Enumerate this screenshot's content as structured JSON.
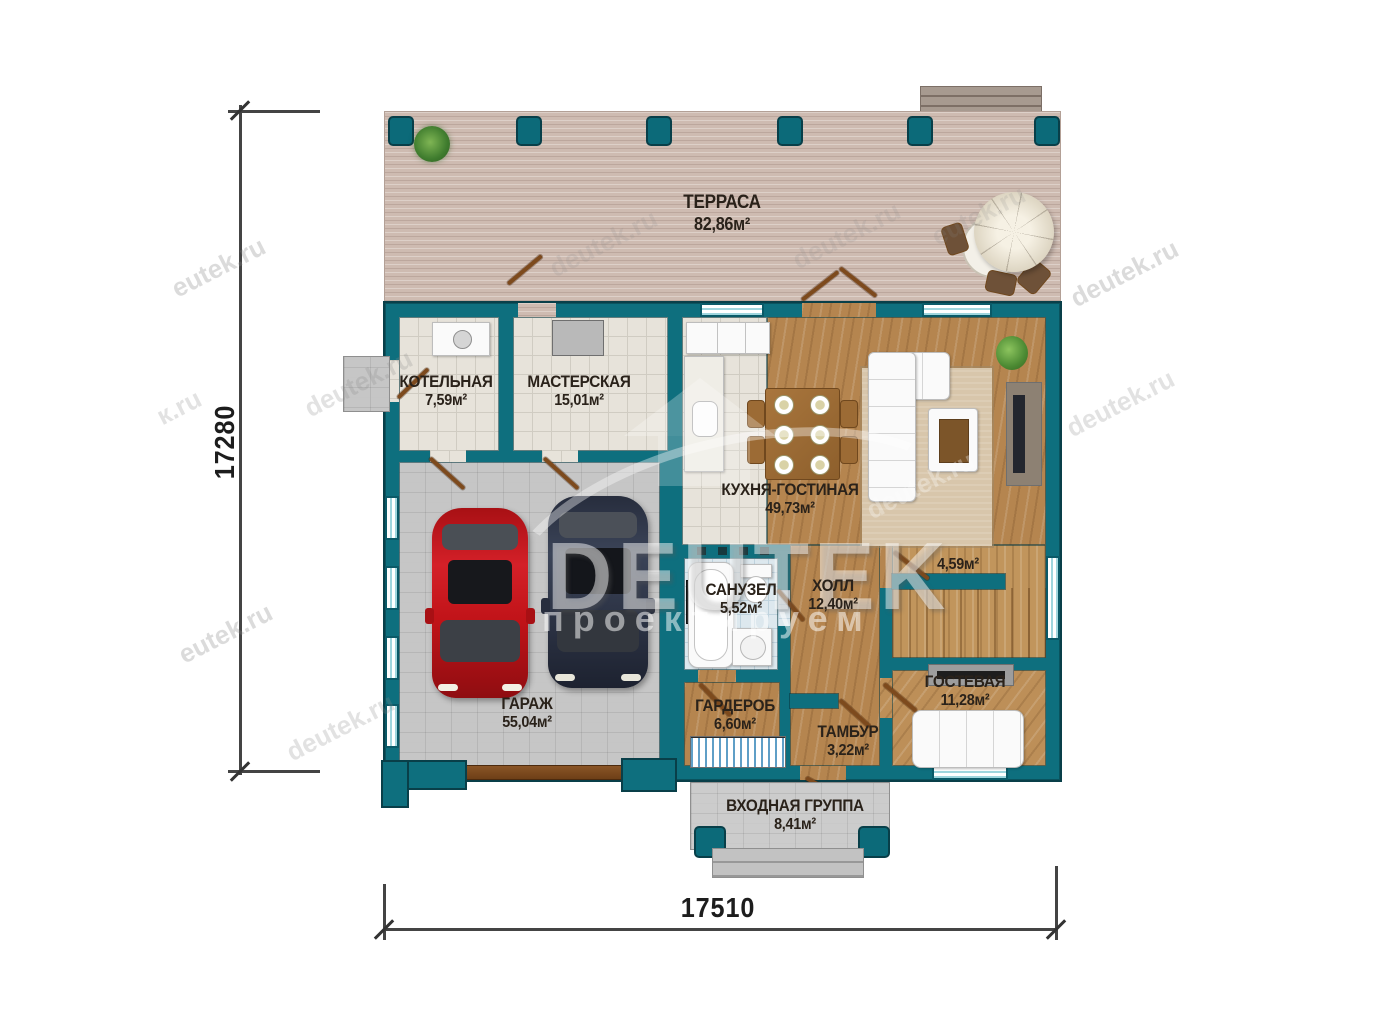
{
  "plan": {
    "dimensions": {
      "left_total": "17280",
      "bottom_total": "17510"
    },
    "rooms": {
      "terrace": {
        "name": "ТЕРРАСА",
        "area": "82,86м²"
      },
      "boiler": {
        "name": "КОТЕЛЬНАЯ",
        "area": "7,59м²"
      },
      "workshop": {
        "name": "МАСТЕРСКАЯ",
        "area": "15,01м²"
      },
      "kitchen_living": {
        "name": "КУХНЯ-ГОСТИНАЯ",
        "area": "49,73м²"
      },
      "garage": {
        "name": "ГАРАЖ",
        "area": "55,04м²"
      },
      "bathroom": {
        "name": "САНУЗЕЛ",
        "area": "5,52м²"
      },
      "hall": {
        "name": "ХОЛЛ",
        "area": "12,40м²"
      },
      "stairs": {
        "area": "4,59м²"
      },
      "guest": {
        "name": "ГОСТЕВАЯ",
        "area": "11,28м²"
      },
      "wardrobe": {
        "name": "ГАРДЕРОБ",
        "area": "6,60м²"
      },
      "tambour": {
        "name": "ТАМБУР",
        "area": "3,22м²"
      },
      "entrance": {
        "name": "ВХОДНАЯ ГРУППА",
        "area": "8,41м²"
      }
    },
    "watermark": {
      "logo": "DEUTEK",
      "logo_subtitle": "проектируем",
      "site_a": "eutek.ru",
      "site_b": "deutek.ru",
      "site_partial": "к.ru"
    },
    "colors": {
      "wall": "#0e6f7e",
      "window_glass": "#9fd6de",
      "car_red": "#c01318",
      "car_blue": "#2e3547"
    }
  }
}
